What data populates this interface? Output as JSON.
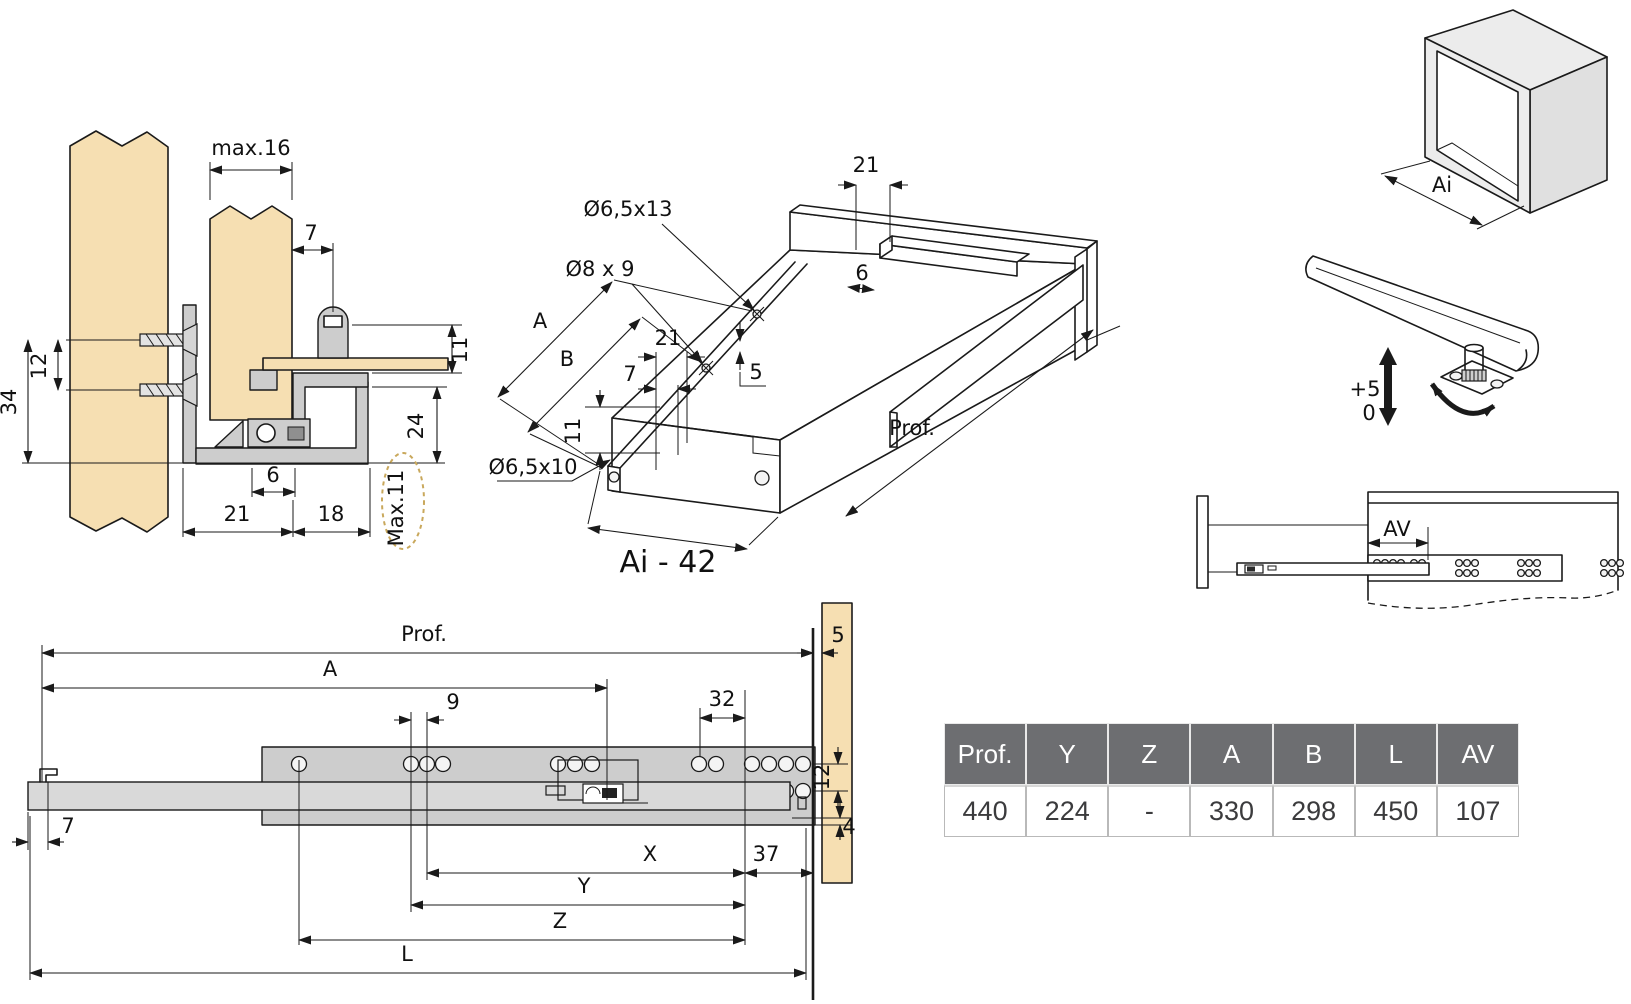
{
  "colors": {
    "wood": "#f6dfb2",
    "metal": "#cdcdcd",
    "line": "#1a1a1a",
    "dashed_ellipse": "#c9a85c",
    "table_header_bg": "#6d6e71",
    "table_header_text": "#ffffff"
  },
  "cross_section": {
    "max16": "max.16",
    "d7": "7",
    "d12": "12",
    "d34": "34",
    "d11": "11",
    "d24": "24",
    "d6": "6",
    "d21": "21",
    "d18": "18",
    "max11": "Max.11"
  },
  "iso_drawer": {
    "d21_top": "21",
    "hole_top": "Ø6,5x13",
    "hole_mid": "Ø8 x 9",
    "d6": "6",
    "dim_a": "A",
    "dim_b": "B",
    "d21_left": "21",
    "d7": "7",
    "d5": "5",
    "d11": "11",
    "hole_front": "Ø6,5x10",
    "prof": "Prof.",
    "ai_minus": "Ai - 42"
  },
  "cabinet_iso": {
    "ai": "Ai"
  },
  "height_adjust": {
    "plus": "+5",
    "zero": "0"
  },
  "extension_view": {
    "av": "AV"
  },
  "side_view": {
    "prof": "Prof.",
    "dim_a": "A",
    "d9": "9",
    "d32": "32",
    "d5": "5",
    "d12": "12",
    "d7": "7",
    "d4": "4",
    "dim_x": "X",
    "d37": "37",
    "dim_y": "Y",
    "dim_z": "Z",
    "dim_l": "L"
  },
  "table": {
    "headers": [
      "Prof.",
      "Y",
      "Z",
      "A",
      "B",
      "L",
      "AV"
    ],
    "rows": [
      [
        "440",
        "224",
        "-",
        "330",
        "298",
        "450",
        "107"
      ]
    ]
  }
}
